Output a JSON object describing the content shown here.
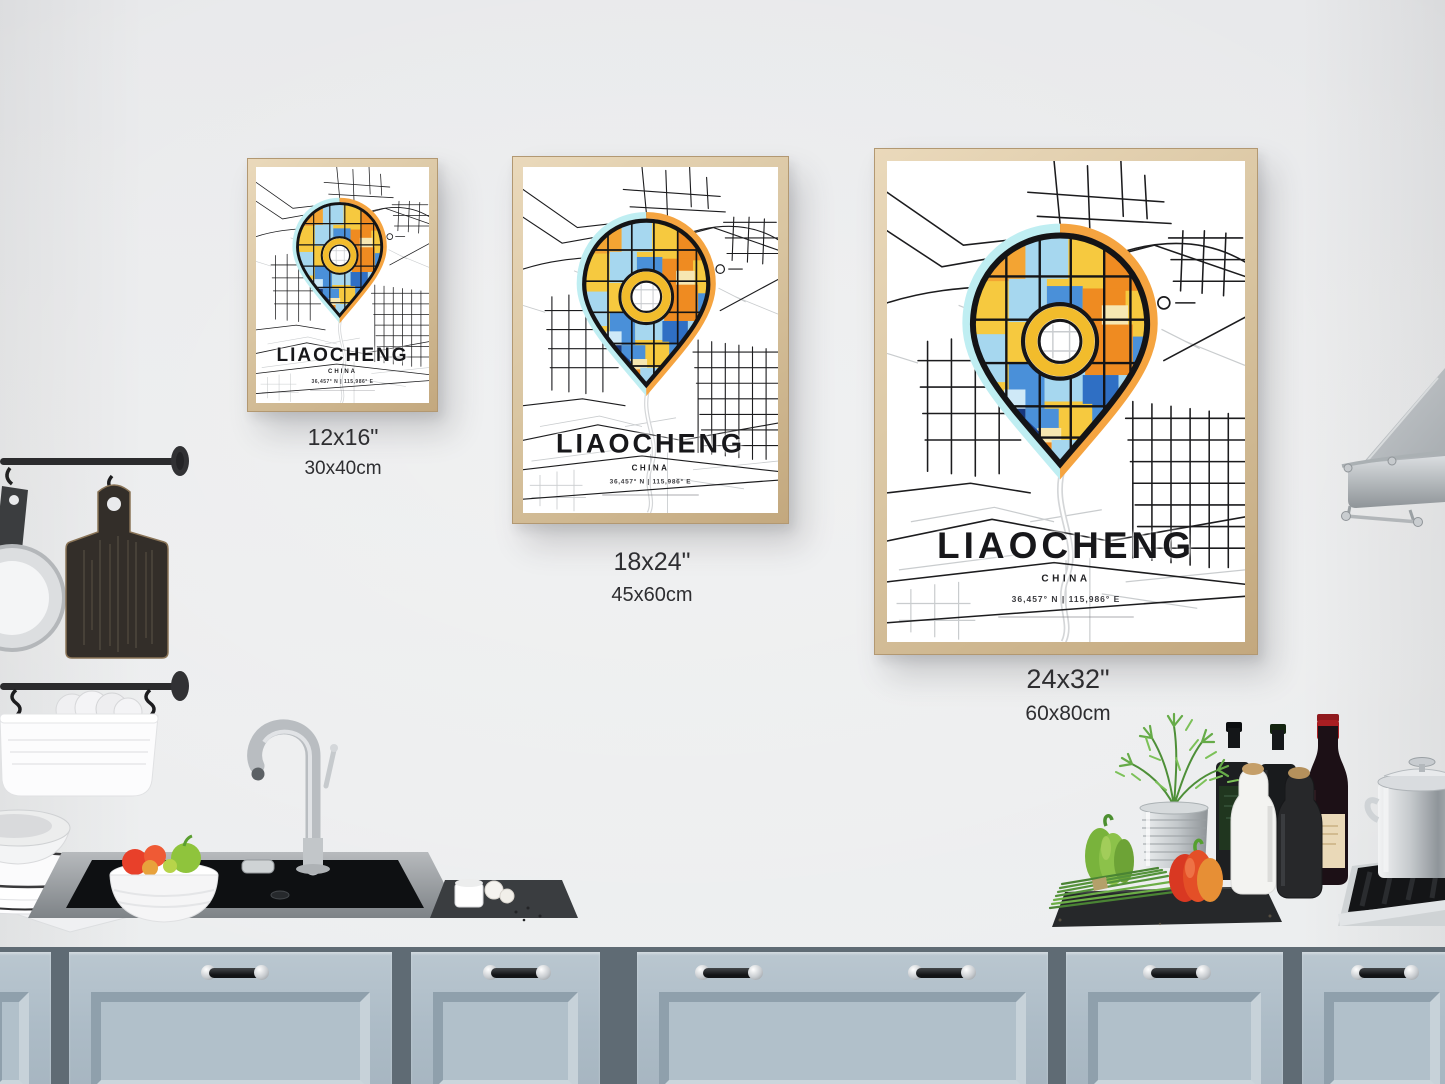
{
  "scene": {
    "setting": "kitchen wall with three framed city map posters above a counter",
    "objects": [
      "hanging-rail",
      "frying-pan",
      "wooden-cutting-board",
      "utensil-basket",
      "plate-stack",
      "vegetable-bowl",
      "kitchen-sink",
      "faucet",
      "garlic-board",
      "herb-pot",
      "green-bell-pepper",
      "red-bell-pepper",
      "chives-bundle",
      "serving-board",
      "pepper-grinder-white",
      "pepper-grinder-black",
      "oil-bottles",
      "wine-bottle",
      "gas-hob",
      "stock-pot",
      "range-hood",
      "cabinet-doors"
    ]
  },
  "posters": [
    {
      "variant": "small",
      "title": "LIAOCHENG",
      "country": "CHINA",
      "coordinates": "36,457° N | 115,986° E",
      "size_imperial": "12x16\"",
      "size_metric": "30x40cm"
    },
    {
      "variant": "medium",
      "title": "LIAOCHENG",
      "country": "CHINA",
      "coordinates": "36,457° N | 115,986° E",
      "size_imperial": "18x24\"",
      "size_metric": "45x60cm"
    },
    {
      "variant": "large",
      "title": "LIAOCHENG",
      "country": "CHINA",
      "coordinates": "36,457° N | 115,986° E",
      "size_imperial": "24x32\"",
      "size_metric": "60x80cm"
    }
  ],
  "colors": {
    "wall": "#e7e8ea",
    "counter": "#f6f8f9",
    "cabinet_face": "#adbcc7",
    "cabinet_gap": "#5f6b74",
    "frame_wood": "#d9c5a1",
    "label_text": "#2e2e31",
    "road_black": "#1c1c1e",
    "road_gray": "#c9ccce",
    "pin_yellow": "#f6c93f",
    "pin_orange": "#ef8b21",
    "pin_light_orange": "#f3a433",
    "pin_light_blue": "#a6d7ef",
    "pin_blue": "#4a90d9",
    "pin_navy": "#16377e",
    "halo_cyan": "#bfeef2",
    "halo_orange": "#f5a440",
    "ring_yellow": "#f2bc2c"
  }
}
